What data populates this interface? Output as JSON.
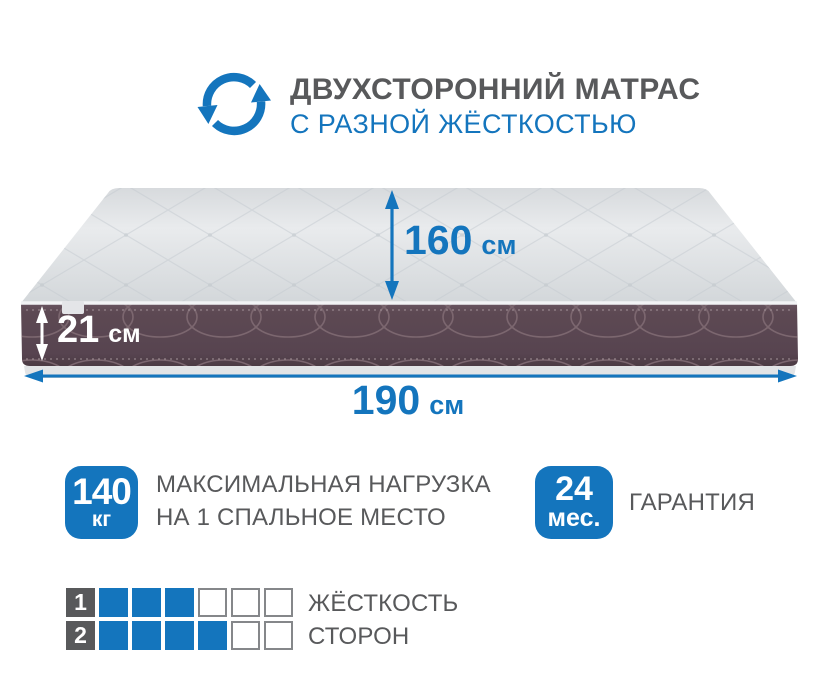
{
  "colors": {
    "accent_blue": "#1475BD",
    "text_gray": "#58595B",
    "mattress_side_plum": "#5A4750",
    "mattress_top_gray": "#E3E6E9"
  },
  "header": {
    "icon": "rotate-arrows-icon",
    "title": "ДВУХСТОРОННИЙ МАТРАС",
    "subtitle": "С РАЗНОЙ ЖЁСТКОСТЬЮ"
  },
  "dimensions": {
    "width": {
      "value": "160",
      "unit": "см"
    },
    "thickness": {
      "value": "21",
      "unit": "см"
    },
    "length": {
      "value": "190",
      "unit": "см"
    }
  },
  "max_load": {
    "value": "140",
    "unit": "кг",
    "label_line1": "МАКСИМАЛЬНАЯ НАГРУЗКА",
    "label_line2": "НА 1 СПАЛЬНОЕ МЕСТО"
  },
  "warranty": {
    "value": "24",
    "unit": "мес.",
    "label": "ГАРАНТИЯ"
  },
  "firmness": {
    "label_line1": "ЖЁСТКОСТЬ",
    "label_line2": "СТОРОН",
    "scale_max": 6,
    "rows": [
      {
        "side": "1",
        "level": 3
      },
      {
        "side": "2",
        "level": 4
      }
    ]
  }
}
